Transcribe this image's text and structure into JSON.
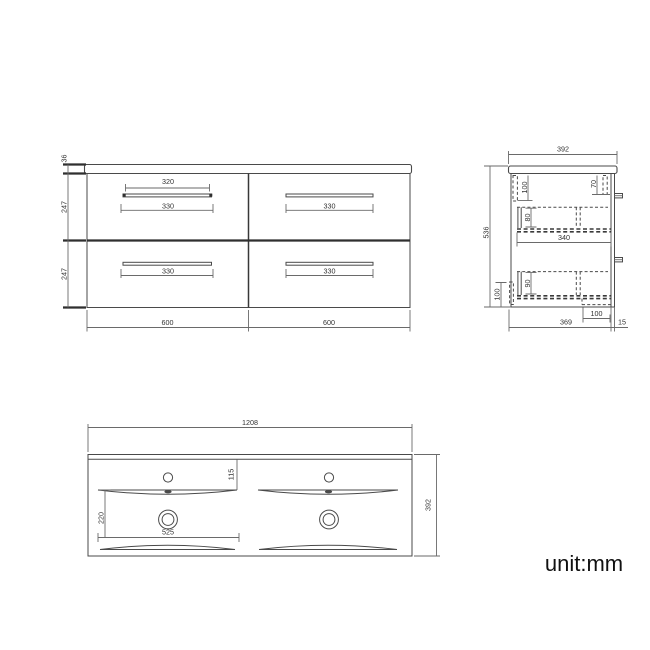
{
  "drawing": {
    "unit_label": "unit:mm",
    "front_view": {
      "counter_thickness": "36",
      "row_heights": [
        "247",
        "247"
      ],
      "handle_width_inner": "320",
      "handle_widths": [
        "330",
        "330",
        "330",
        "330"
      ],
      "cabinet_widths": [
        "600",
        "600"
      ]
    },
    "side_view": {
      "depth": "392",
      "height": "536",
      "front_top_inset": "100",
      "back_top_inset": "70",
      "mid_drawer_depth": "80",
      "drawer_length": "340",
      "low_drawer_depth": "90",
      "bottom_front_inset": "100",
      "back_recess": "100",
      "body_depth": "369",
      "rail_thickness": "15"
    },
    "basin_view": {
      "total_width": "1208",
      "total_depth": "392",
      "tap_to_basin": "115",
      "basin_front_depth": "220",
      "basin_width": "525"
    }
  }
}
